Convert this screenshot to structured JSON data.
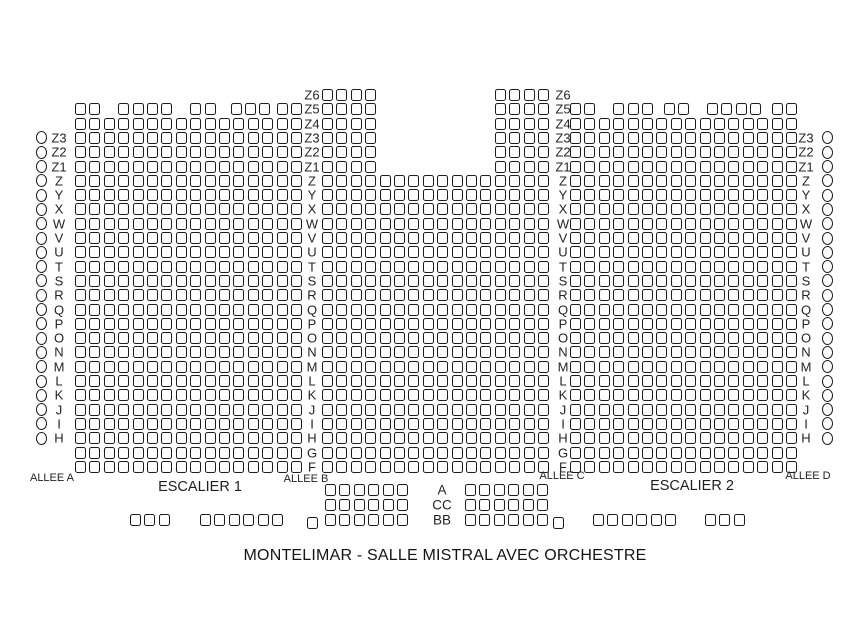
{
  "title": "MONTELIMAR - SALLE MISTRAL AVEC ORCHESTRE",
  "labels": {
    "allee_a": "ALLEE A",
    "escalier_1": "ESCALIER 1",
    "allee_b": "ALLEE B",
    "allee_c": "ALLEE C",
    "escalier_2": "ESCALIER 2",
    "allee_d": "ALLEE D"
  },
  "row_names_main": [
    "Z6",
    "Z5",
    "Z4",
    "Z3",
    "Z2",
    "Z1",
    "Z",
    "Y",
    "X",
    "W",
    "V",
    "U",
    "T",
    "S",
    "R",
    "Q",
    "P",
    "O",
    "N",
    "M",
    "L",
    "K",
    "J",
    "I",
    "H",
    "G",
    "F"
  ],
  "row_names_side": [
    "Z3",
    "Z2",
    "Z1",
    "Z",
    "Y",
    "X",
    "W",
    "V",
    "U",
    "T",
    "S",
    "R",
    "Q",
    "P",
    "O",
    "N",
    "M",
    "L",
    "K",
    "J",
    "I",
    "H"
  ],
  "row_names_orchestre": [
    "A",
    "CC",
    "BB"
  ],
  "colors": {
    "ink": "#1c1c1c",
    "background": "#ffffff"
  },
  "seating": {
    "grid": {
      "y0": 89,
      "y_pitch": 14.3,
      "x_pitch": 14.4,
      "seat_w": 11,
      "seat_h": 12
    },
    "blocks": [
      {
        "name": "left-circles",
        "kind": "circles",
        "x": 36,
        "y0": 131.9,
        "y_pitch": 14.3,
        "repeat": 22
      },
      {
        "name": "left-row-labels",
        "kind": "labels",
        "x": 59,
        "y0": 131.9,
        "y_pitch": 14.3,
        "labels": [
          "Z3",
          "Z2",
          "Z1",
          "Z",
          "Y",
          "X",
          "W",
          "V",
          "U",
          "T",
          "S",
          "R",
          "Q",
          "P",
          "O",
          "N",
          "M",
          "L",
          "K",
          "J",
          "I",
          "H"
        ]
      },
      {
        "name": "parterre-left",
        "kind": "seats",
        "x0": 75,
        "y0": 103.3,
        "rows": [
          {
            "row": "Z5",
            "groups": [
              [
                0,
                2
              ],
              [
                3,
                4
              ],
              [
                8,
                2
              ],
              [
                10.8,
                3
              ],
              [
                14,
                2
              ]
            ]
          },
          {
            "row": "Z4",
            "n": 16
          },
          {
            "row": "Z3",
            "n": 16
          },
          {
            "row": "Z2",
            "n": 16
          },
          {
            "row": "Z1",
            "n": 16
          },
          {
            "row": "Z",
            "n": 16
          },
          {
            "row": "Y",
            "n": 16
          },
          {
            "row": "X",
            "n": 16
          },
          {
            "row": "W",
            "n": 16
          },
          {
            "row": "V",
            "n": 16
          },
          {
            "row": "U",
            "n": 16
          },
          {
            "row": "T",
            "n": 16
          },
          {
            "row": "S",
            "n": 16
          },
          {
            "row": "R",
            "n": 16
          },
          {
            "row": "Q",
            "n": 16
          },
          {
            "row": "P",
            "n": 16
          },
          {
            "row": "O",
            "n": 16
          },
          {
            "row": "N",
            "n": 16
          },
          {
            "row": "M",
            "n": 16
          },
          {
            "row": "L",
            "n": 16
          },
          {
            "row": "K",
            "n": 16
          },
          {
            "row": "J",
            "n": 16
          },
          {
            "row": "I",
            "n": 16
          },
          {
            "row": "H",
            "n": 16
          },
          {
            "row": "G",
            "n": 16
          },
          {
            "row": "F",
            "n": 16
          }
        ]
      },
      {
        "name": "center-left-row-labels",
        "kind": "labels",
        "x": 312,
        "y0": 89,
        "y_pitch": 14.3,
        "labels": [
          "Z6",
          "Z5",
          "Z4",
          "Z3",
          "Z2",
          "Z1",
          "Z",
          "Y",
          "X",
          "W",
          "V",
          "U",
          "T",
          "S",
          "R",
          "Q",
          "P",
          "O",
          "N",
          "M",
          "L",
          "K",
          "J",
          "I",
          "H",
          "G",
          "F"
        ]
      },
      {
        "name": "parterre-center",
        "kind": "seats",
        "x0": 322,
        "y0": 89,
        "rows": [
          {
            "row": "Z6",
            "groups": [
              [
                0,
                4
              ],
              [
                12,
                4
              ]
            ]
          },
          {
            "row": "Z5",
            "groups": [
              [
                0,
                4
              ],
              [
                12,
                4
              ]
            ]
          },
          {
            "row": "Z4",
            "groups": [
              [
                0,
                4
              ],
              [
                12,
                4
              ]
            ]
          },
          {
            "row": "Z3",
            "groups": [
              [
                0,
                4
              ],
              [
                12,
                4
              ]
            ]
          },
          {
            "row": "Z2",
            "groups": [
              [
                0,
                4
              ],
              [
                12,
                4
              ]
            ]
          },
          {
            "row": "Z1",
            "groups": [
              [
                0,
                4
              ],
              [
                12,
                4
              ]
            ]
          },
          {
            "row": "Z",
            "n": 16
          },
          {
            "row": "Y",
            "n": 16
          },
          {
            "row": "X",
            "n": 16
          },
          {
            "row": "W",
            "n": 16
          },
          {
            "row": "V",
            "n": 16
          },
          {
            "row": "U",
            "n": 16
          },
          {
            "row": "T",
            "n": 16
          },
          {
            "row": "S",
            "n": 16
          },
          {
            "row": "R",
            "n": 16
          },
          {
            "row": "Q",
            "n": 16
          },
          {
            "row": "P",
            "n": 16
          },
          {
            "row": "O",
            "n": 16
          },
          {
            "row": "N",
            "n": 16
          },
          {
            "row": "M",
            "n": 16
          },
          {
            "row": "L",
            "n": 16
          },
          {
            "row": "K",
            "n": 16
          },
          {
            "row": "J",
            "n": 16
          },
          {
            "row": "I",
            "n": 16
          },
          {
            "row": "H",
            "n": 16
          },
          {
            "row": "G",
            "n": 16
          },
          {
            "row": "F",
            "n": 16
          }
        ]
      },
      {
        "name": "center-right-row-labels",
        "kind": "labels",
        "x": 563,
        "y0": 89,
        "y_pitch": 14.3,
        "labels": [
          "Z6",
          "Z5",
          "Z4",
          "Z3",
          "Z2",
          "Z1",
          "Z",
          "Y",
          "X",
          "W",
          "V",
          "U",
          "T",
          "S",
          "R",
          "Q",
          "P",
          "O",
          "N",
          "M",
          "L",
          "K",
          "J",
          "I",
          "H",
          "G",
          "F"
        ]
      },
      {
        "name": "parterre-right",
        "kind": "seats",
        "x0": 570,
        "y0": 103.3,
        "rows": [
          {
            "row": "Z5",
            "groups": [
              [
                0,
                2
              ],
              [
                3,
                3
              ],
              [
                6.5,
                2
              ],
              [
                9.5,
                4
              ],
              [
                14,
                2
              ]
            ]
          },
          {
            "row": "Z4",
            "n": 16
          },
          {
            "row": "Z3",
            "n": 16
          },
          {
            "row": "Z2",
            "n": 16
          },
          {
            "row": "Z1",
            "n": 16
          },
          {
            "row": "Z",
            "n": 16
          },
          {
            "row": "Y",
            "n": 16
          },
          {
            "row": "X",
            "n": 16
          },
          {
            "row": "W",
            "n": 16
          },
          {
            "row": "V",
            "n": 16
          },
          {
            "row": "U",
            "n": 16
          },
          {
            "row": "T",
            "n": 16
          },
          {
            "row": "S",
            "n": 16
          },
          {
            "row": "R",
            "n": 16
          },
          {
            "row": "Q",
            "n": 16
          },
          {
            "row": "P",
            "n": 16
          },
          {
            "row": "O",
            "n": 16
          },
          {
            "row": "N",
            "n": 16
          },
          {
            "row": "M",
            "n": 16
          },
          {
            "row": "L",
            "n": 16
          },
          {
            "row": "K",
            "n": 16
          },
          {
            "row": "J",
            "n": 16
          },
          {
            "row": "I",
            "n": 16
          },
          {
            "row": "H",
            "n": 16
          },
          {
            "row": "G",
            "n": 16
          },
          {
            "row": "F",
            "n": 16
          }
        ]
      },
      {
        "name": "right-row-labels",
        "kind": "labels",
        "x": 806,
        "y0": 131.9,
        "y_pitch": 14.3,
        "labels": [
          "Z3",
          "Z2",
          "Z1",
          "Z",
          "Y",
          "X",
          "W",
          "V",
          "U",
          "T",
          "S",
          "R",
          "Q",
          "P",
          "O",
          "N",
          "M",
          "L",
          "K",
          "J",
          "I",
          "H"
        ]
      },
      {
        "name": "right-circles",
        "kind": "circles",
        "x": 822,
        "y0": 131.9,
        "y_pitch": 14.3,
        "repeat": 22
      },
      {
        "name": "orchestre-left",
        "kind": "seats",
        "x0": 325,
        "y0": 484,
        "y_pitch": 15,
        "rows": [
          {
            "row": "A",
            "n": 6
          },
          {
            "row": "CC",
            "n": 6
          },
          {
            "row": "BB",
            "n": 6
          }
        ]
      },
      {
        "name": "orchestre-row-labels",
        "kind": "labels",
        "x": 442,
        "y0": 484,
        "y_pitch": 15,
        "cls": "big",
        "labels": [
          "A",
          "CC",
          "BB"
        ]
      },
      {
        "name": "orchestre-right",
        "kind": "seats",
        "x0": 465,
        "y0": 484,
        "y_pitch": 15,
        "rows": [
          {
            "row": "A",
            "n": 6
          },
          {
            "row": "CC",
            "n": 6
          },
          {
            "row": "BB",
            "n": 6
          }
        ]
      },
      {
        "name": "orchestre-far-left-3",
        "kind": "seats",
        "x0": 130,
        "y0": 514,
        "rows": [
          {
            "row": "BB",
            "n": 3
          }
        ]
      },
      {
        "name": "orchestre-left-6",
        "kind": "seats",
        "x0": 200,
        "y0": 514,
        "rows": [
          {
            "row": "BB",
            "n": 6
          }
        ]
      },
      {
        "name": "orchestre-left-single",
        "kind": "seats",
        "x0": 307,
        "y0": 517,
        "rows": [
          {
            "row": "BB",
            "n": 1
          }
        ]
      },
      {
        "name": "orchestre-right-single",
        "kind": "seats",
        "x0": 553,
        "y0": 517,
        "rows": [
          {
            "row": "BB",
            "n": 1
          }
        ]
      },
      {
        "name": "orchestre-right-6",
        "kind": "seats",
        "x0": 593,
        "y0": 514,
        "rows": [
          {
            "row": "BB",
            "n": 6
          }
        ]
      },
      {
        "name": "orchestre-far-right-3",
        "kind": "seats",
        "x0": 705,
        "y0": 514,
        "rows": [
          {
            "row": "BB",
            "n": 3
          }
        ]
      }
    ]
  }
}
